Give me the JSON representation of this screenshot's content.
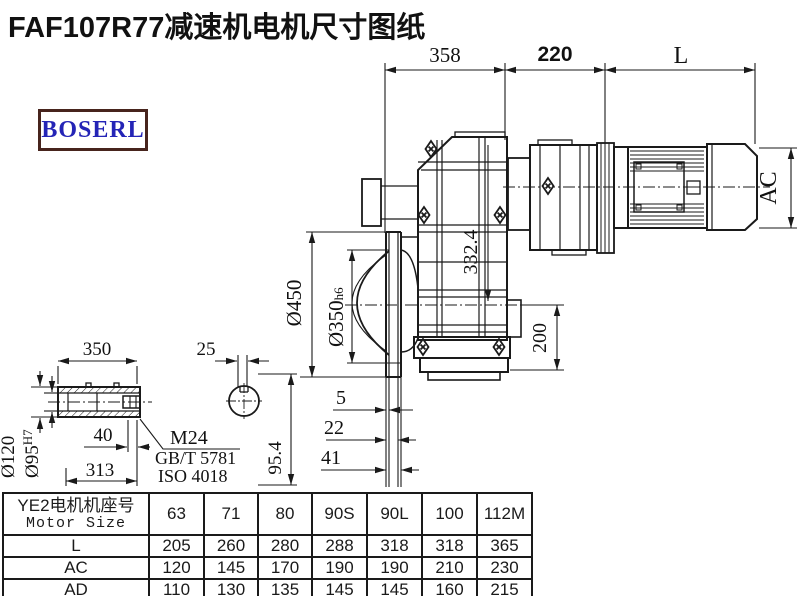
{
  "title": "FAF107R77减速机电机尺寸图纸",
  "logo_text": "BOSERL",
  "dims": {
    "top_left": "358",
    "top_mid": "220",
    "top_right": "L",
    "motor_od": "AC",
    "height_332": "332.4",
    "flange_od": "Ø450",
    "spigot_main": "Ø350",
    "spigot_tol": "h6",
    "axis_to_base": "200",
    "face_1": "5",
    "face_2": "22",
    "face_3": "41",
    "shaft_len": "350",
    "key_width": "25",
    "shaft_od": "Ø120",
    "bore_main": "Ø95",
    "bore_tol": "H7",
    "groove_40": "40",
    "len_313": "313",
    "section_h": "95.4",
    "thread": "M24",
    "std_gb": "GB/T 5781",
    "std_iso": "ISO 4018"
  },
  "table": {
    "header_line1": "YE2电机机座号",
    "header_line2": "Motor Size",
    "columns": [
      "63",
      "71",
      "80",
      "90S",
      "90L",
      "100",
      "112M"
    ],
    "rows": [
      {
        "label": "L",
        "values": [
          "205",
          "260",
          "280",
          "288",
          "318",
          "318",
          "365"
        ]
      },
      {
        "label": "AC",
        "values": [
          "120",
          "145",
          "170",
          "190",
          "190",
          "210",
          "230"
        ]
      },
      {
        "label": "AD",
        "values": [
          "110",
          "130",
          "135",
          "145",
          "145",
          "160",
          "215"
        ]
      }
    ]
  },
  "colors": {
    "line": "#1a1a1a",
    "logo_border": "#47241d",
    "logo_text": "#2424b6",
    "background": "#ffffff"
  }
}
